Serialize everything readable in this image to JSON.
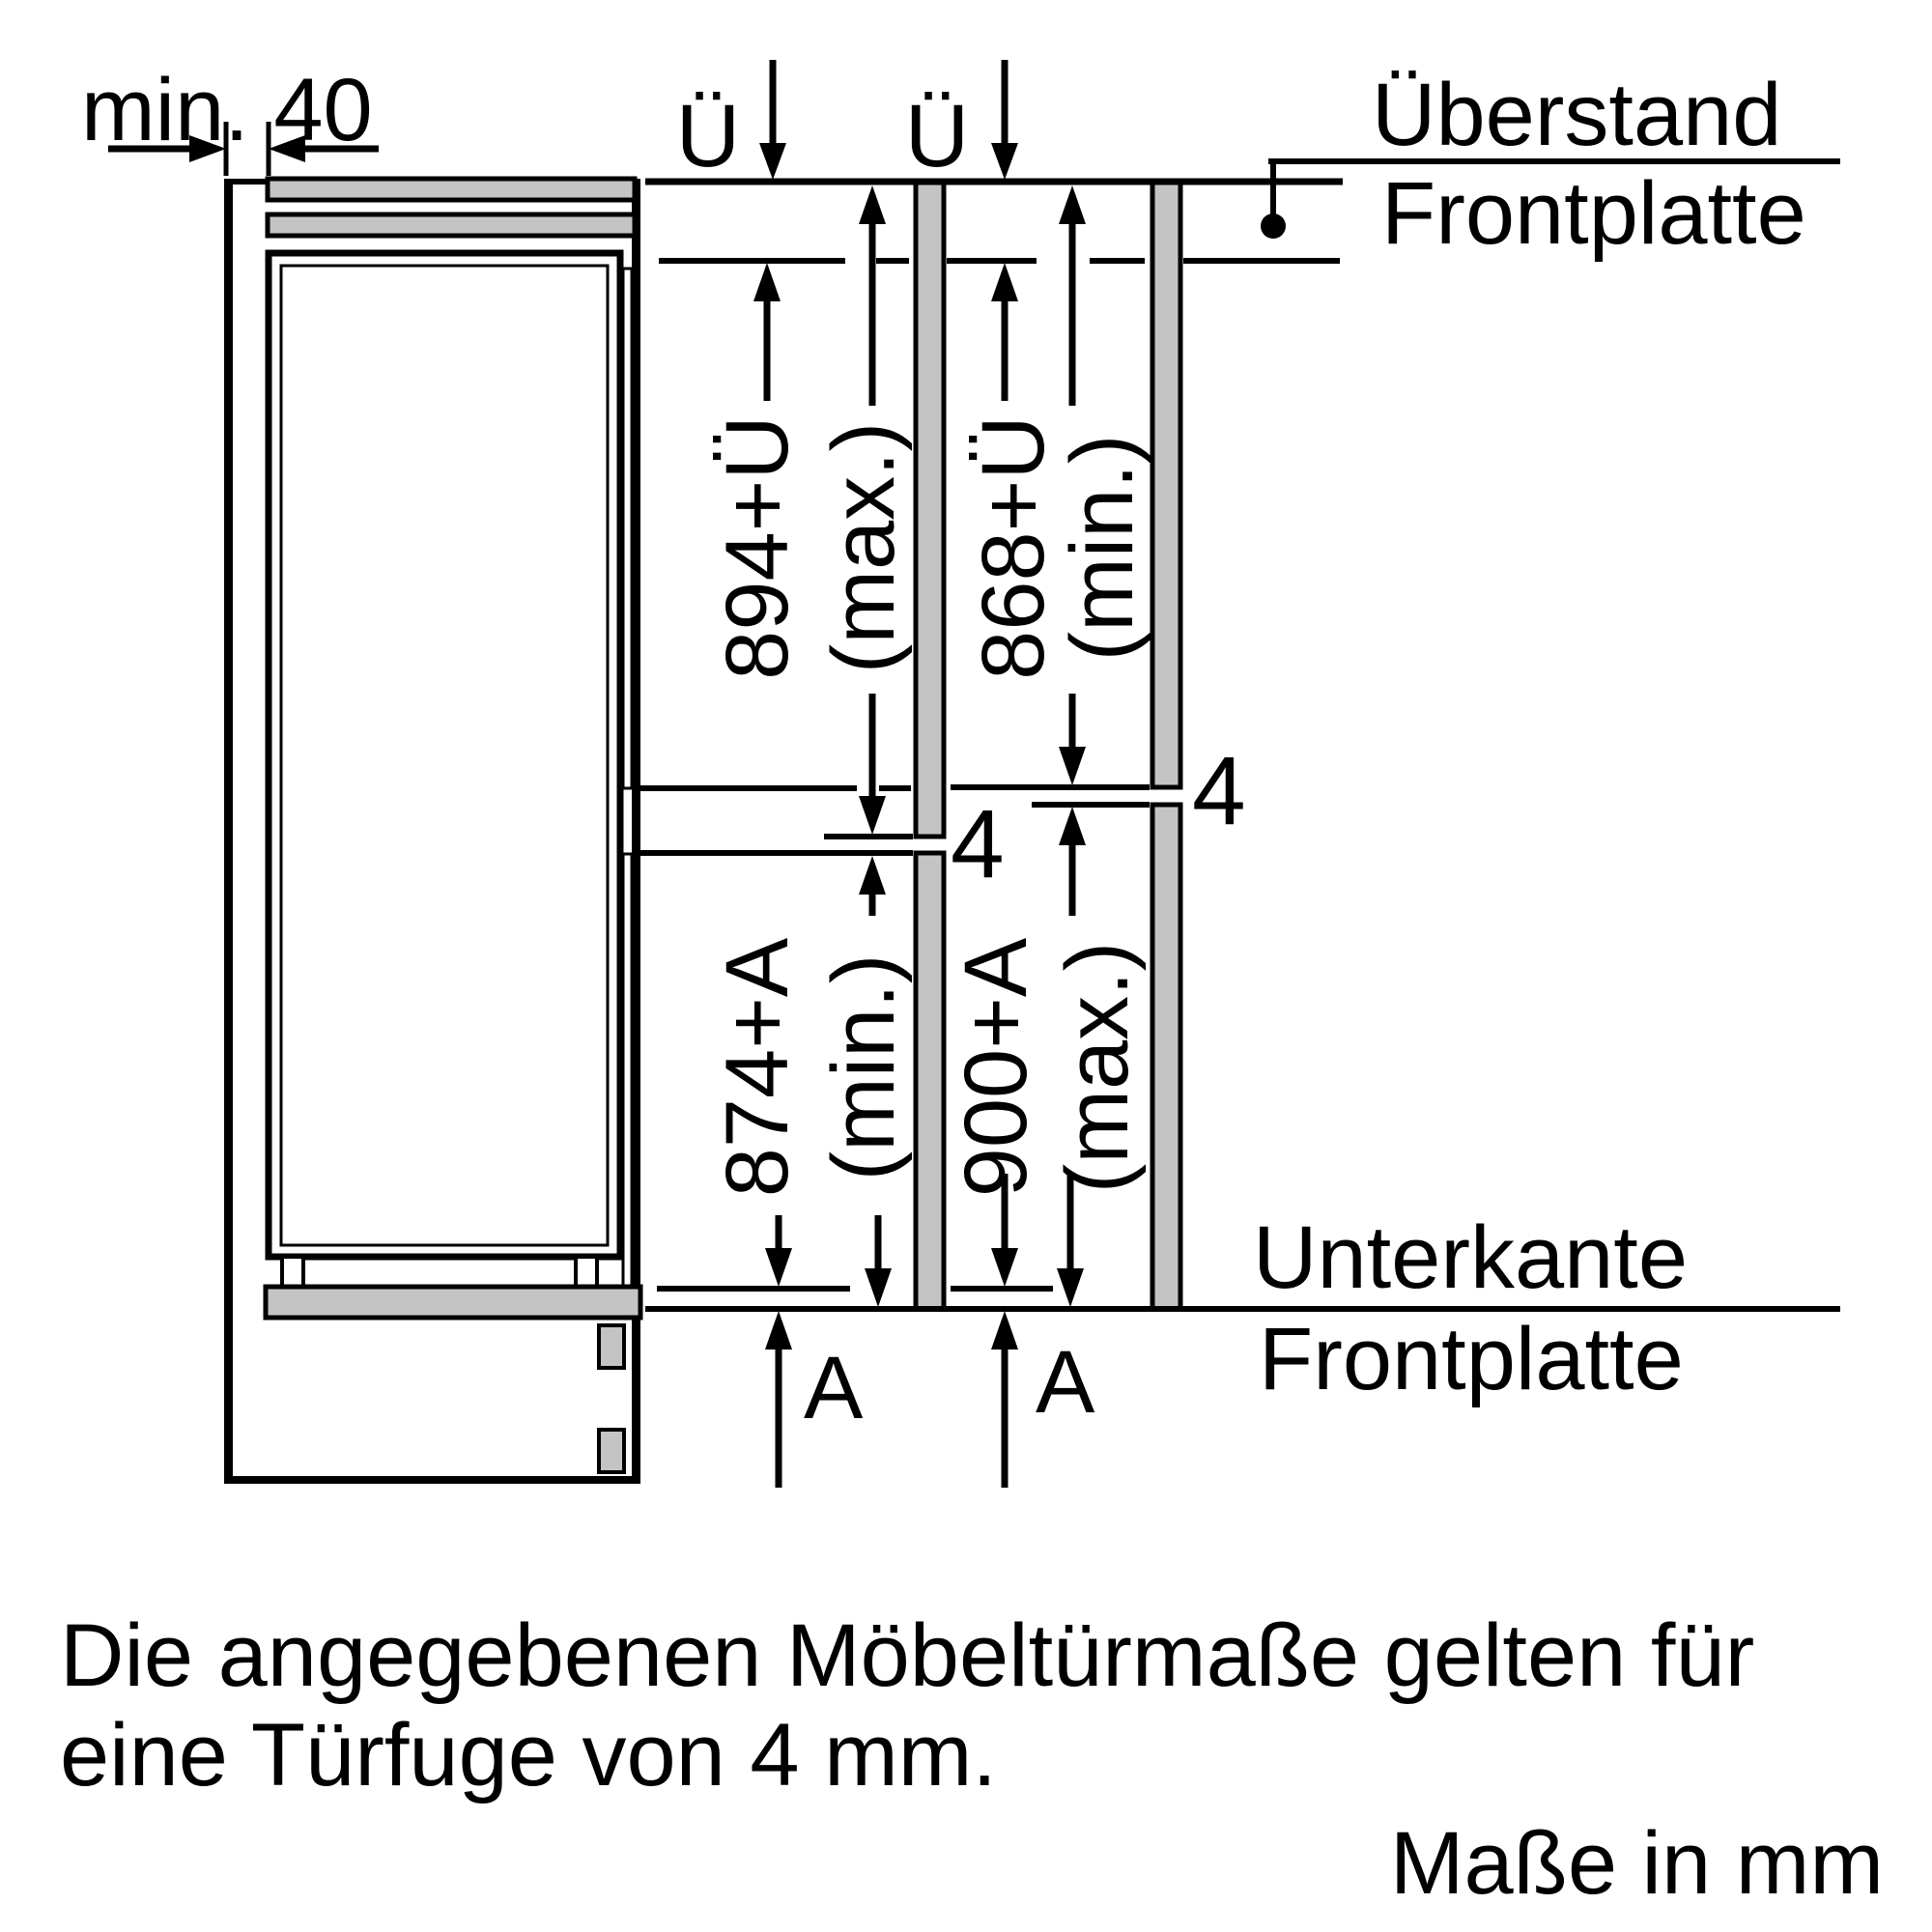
{
  "title": "Einbauskizze Möbeltüren (Kühl-Gefrier-Kombination)",
  "colors": {
    "line": "#000000",
    "panel_gray": "#c4c4c4",
    "background": "#ffffff"
  },
  "top_left": {
    "min_gap_label": "min. 40"
  },
  "overhang_labels": {
    "ue_left": "Ü",
    "ue_right": "Ü"
  },
  "leader_top_right": {
    "line1": "Überstand",
    "line2": "Frontplatte"
  },
  "gap_labels": {
    "panel_left": "4",
    "panel_right": "4"
  },
  "dimensions": {
    "left_upper": {
      "value": "894+Ü",
      "qualifier": "(max.)"
    },
    "right_upper": {
      "value": "868+Ü",
      "qualifier": "(min.)"
    },
    "left_lower": {
      "value": "874+A",
      "qualifier": "(min.)"
    },
    "right_lower": {
      "value": "900+A",
      "qualifier": "(max.)"
    }
  },
  "bottom_refs": {
    "a_left": "A",
    "a_right": "A"
  },
  "leader_bottom_right": {
    "line1": "Unterkante",
    "line2": "Frontplatte"
  },
  "caption": {
    "line1": "Die angegebenen Möbeltürmaße gelten für",
    "line2": "eine Türfuge von 4 mm."
  },
  "units_note": "Maße in mm"
}
